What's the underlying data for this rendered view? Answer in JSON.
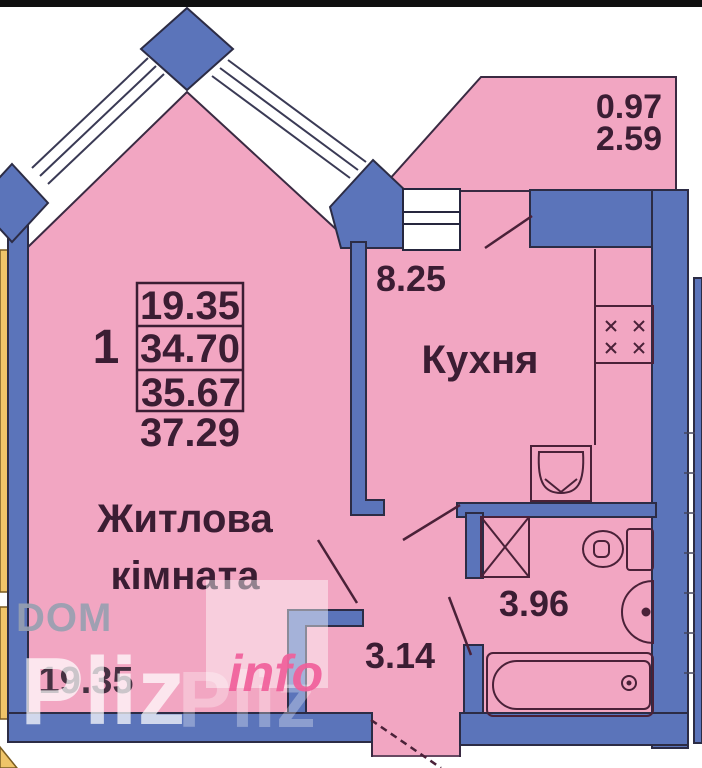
{
  "floor_plan": {
    "summary": {
      "rooms_count": "1",
      "table_rows": [
        "19.35",
        "34.70",
        "35.67"
      ],
      "total_below_table": "37.29"
    },
    "rooms": {
      "living_room": {
        "label_line1": "Житлова",
        "label_line2": "кімната",
        "area": "19.35"
      },
      "kitchen": {
        "label": "Кухня",
        "area": "8.25"
      },
      "hallway": {
        "area": "3.14"
      },
      "bathroom": {
        "area": "3.96"
      },
      "balcony": {
        "area_upper": "0.97",
        "area_lower": "2.59"
      }
    },
    "watermark": {
      "dom": "DOM",
      "pliz": "Pliz",
      "info": "info"
    },
    "colors": {
      "room_fill": "#f2a6c2",
      "wall_fill": "#5b74ba",
      "wall_outline": "#2c2c45",
      "fixture_line": "#4a2138",
      "label_text": "#3b1d33",
      "outside_strip": "#efc469"
    }
  }
}
